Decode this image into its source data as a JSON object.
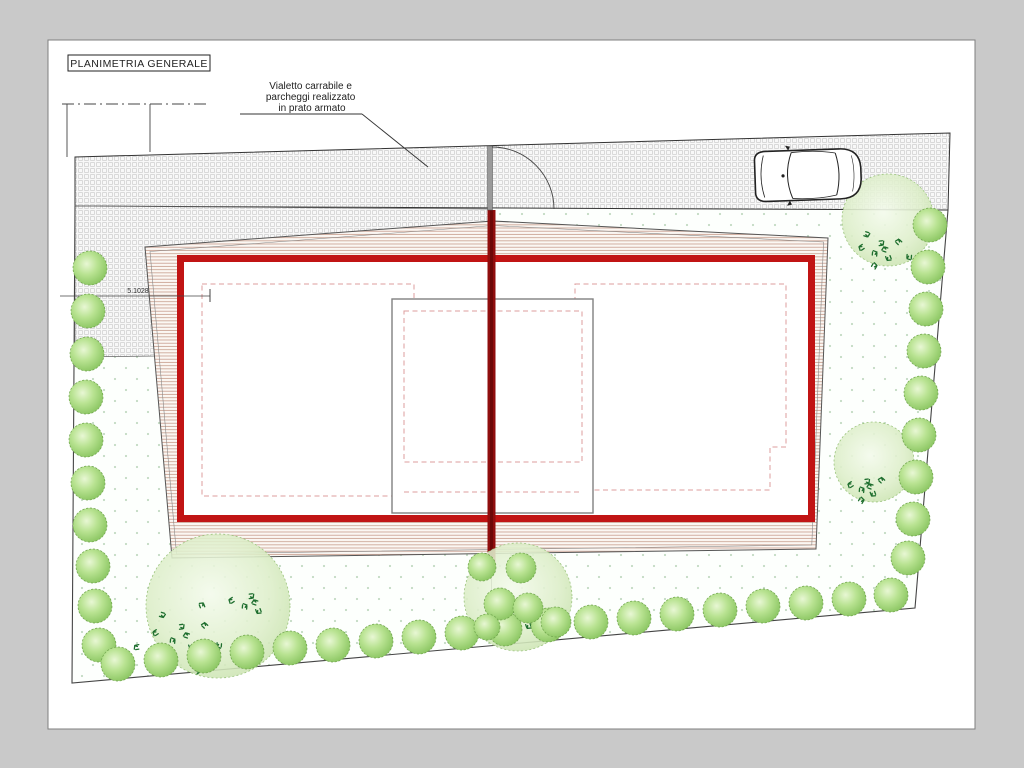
{
  "sheet": {
    "title": "PLANIMETRIA GENERALE"
  },
  "annotation": {
    "line1": "Vialetto carrabile e",
    "line2": "parcheggi realizzato",
    "line3": "in prato armato"
  },
  "dimension": {
    "value": "5.1028"
  },
  "colors": {
    "wall_red": "#c11414",
    "axis_red": "#8f0d0d",
    "axis_core": "#6d0808",
    "hatch_line": "#c79d8d",
    "boundary": "#444444",
    "sprig_green": "#1e6e2e"
  },
  "plan": {
    "bushes": [
      [
        90,
        268,
        17
      ],
      [
        88,
        311,
        17
      ],
      [
        87,
        354,
        17
      ],
      [
        86,
        397,
        17
      ],
      [
        86,
        440,
        17
      ],
      [
        88,
        483,
        17
      ],
      [
        90,
        525,
        17
      ],
      [
        93,
        566,
        17
      ],
      [
        95,
        606,
        17
      ],
      [
        99,
        645,
        17
      ],
      [
        118,
        664,
        17
      ],
      [
        161,
        660,
        17
      ],
      [
        204,
        656,
        17
      ],
      [
        247,
        652,
        17
      ],
      [
        290,
        648,
        17
      ],
      [
        333,
        645,
        17
      ],
      [
        376,
        641,
        17
      ],
      [
        419,
        637,
        17
      ],
      [
        462,
        633,
        17
      ],
      [
        505,
        629,
        17
      ],
      [
        548,
        625,
        17
      ],
      [
        591,
        622,
        17
      ],
      [
        634,
        618,
        17
      ],
      [
        677,
        614,
        17
      ],
      [
        720,
        610,
        17
      ],
      [
        763,
        606,
        17
      ],
      [
        806,
        603,
        17
      ],
      [
        849,
        599,
        17
      ],
      [
        891,
        595,
        17
      ],
      [
        930,
        225,
        17
      ],
      [
        928,
        267,
        17
      ],
      [
        926,
        309,
        17
      ],
      [
        924,
        351,
        17
      ],
      [
        921,
        393,
        17
      ],
      [
        919,
        435,
        17
      ],
      [
        916,
        477,
        17
      ],
      [
        913,
        519,
        17
      ],
      [
        908,
        558,
        17
      ],
      [
        482,
        567,
        14
      ],
      [
        521,
        568,
        15
      ],
      [
        500,
        604,
        16
      ],
      [
        528,
        608,
        15
      ],
      [
        556,
        622,
        15
      ],
      [
        487,
        627,
        13
      ]
    ],
    "trees": [
      [
        888,
        220,
        46
      ],
      [
        874,
        462,
        40
      ],
      [
        218,
        606,
        72
      ],
      [
        518,
        597,
        54
      ]
    ],
    "sprig_clusters": [
      [
        880,
        250,
        9,
        1.2
      ],
      [
        866,
        487,
        7,
        1.0
      ],
      [
        180,
        636,
        12,
        1.6
      ],
      [
        250,
        603,
        5,
        1.2
      ],
      [
        520,
        618,
        8,
        1.2
      ]
    ]
  }
}
